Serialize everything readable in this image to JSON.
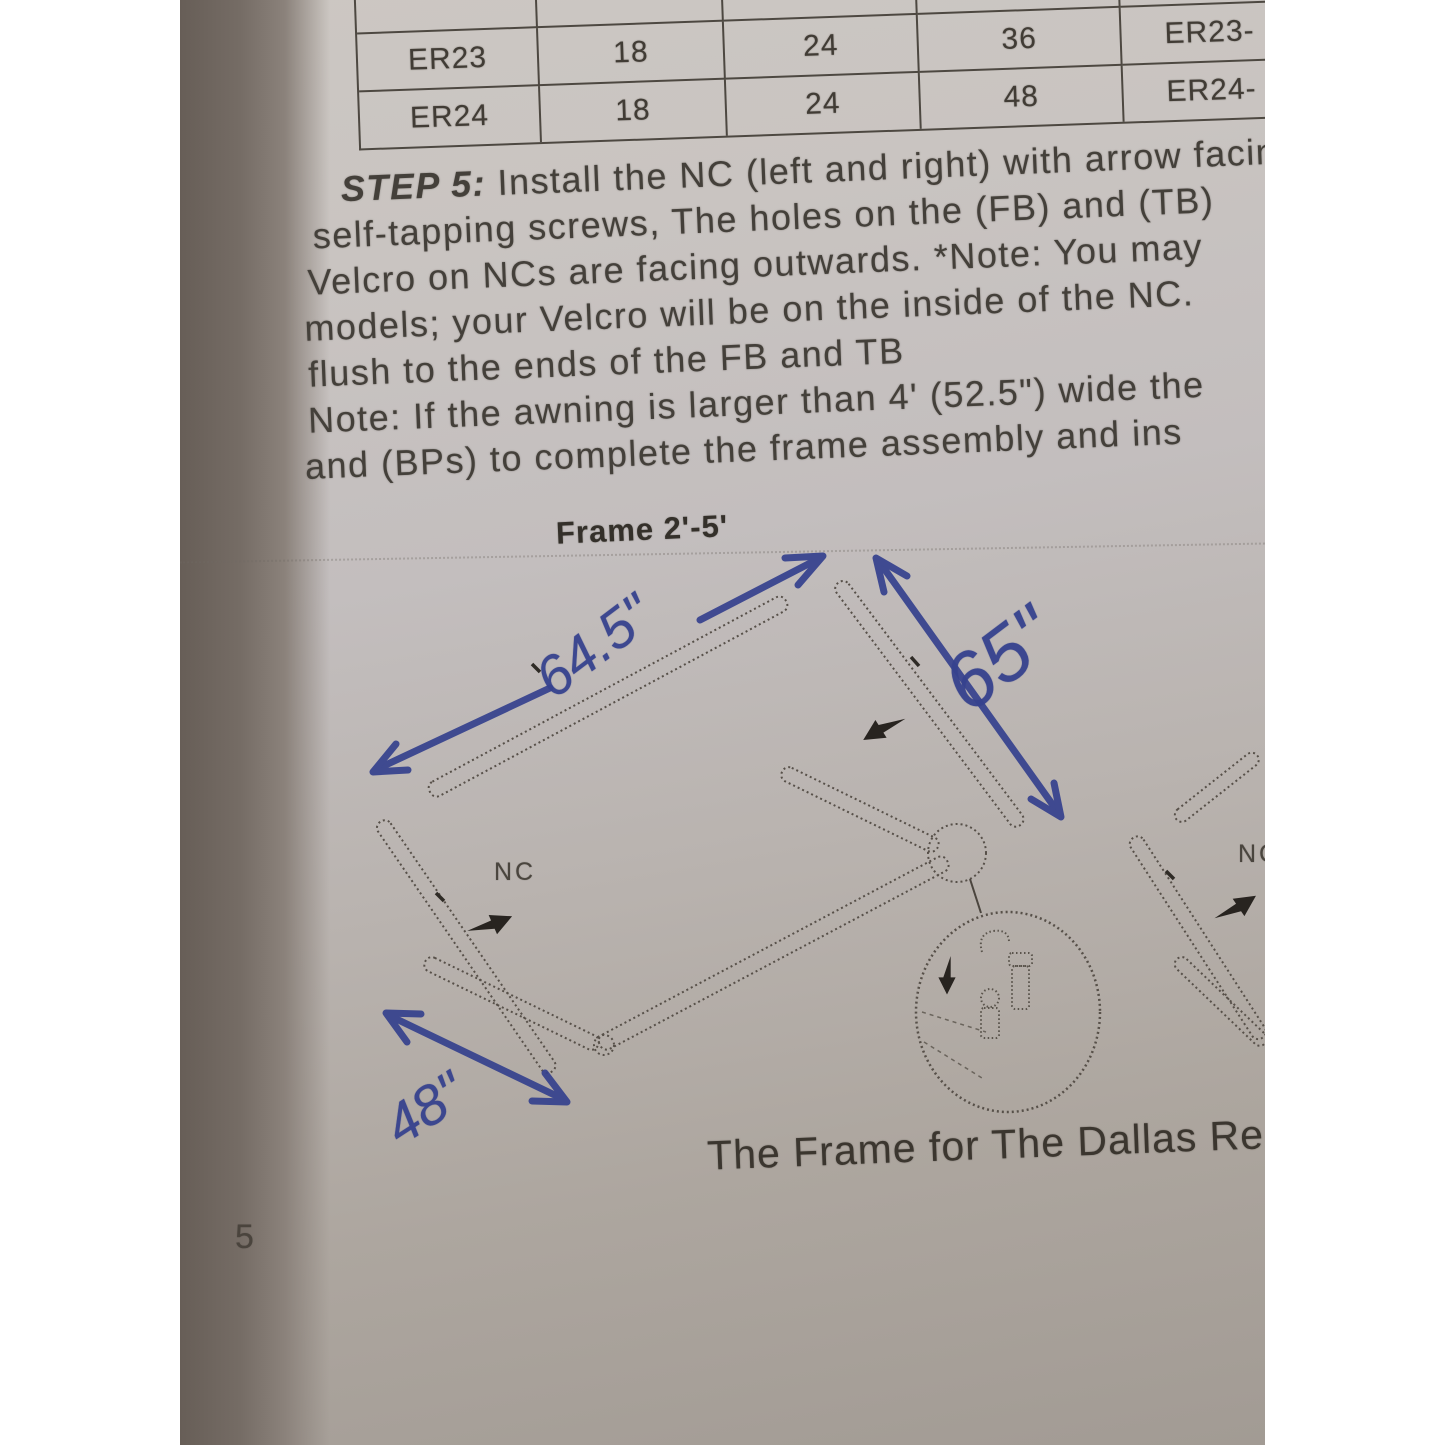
{
  "table": {
    "rows": [
      [
        "ER23",
        "18",
        "24",
        "36",
        "ER23-"
      ],
      [
        "ER24",
        "18",
        "24",
        "48",
        "ER24-"
      ]
    ]
  },
  "instructions": {
    "step_label": "STEP 5:",
    "step_rest": " Install the NC (left and right) with arrow facin",
    "lines": [
      "self-tapping screws, The holes on the (FB) and (TB)",
      "Velcro on NCs are facing outwards. *Note: You may",
      "models; your Velcro will be on the inside of the NC.",
      "flush to the ends of the FB and TB",
      "Note: If the awning is larger than 4' (52.5\") wide the",
      "and (BPs) to complete the frame assembly and ins"
    ]
  },
  "diagram": {
    "frame_label": "Frame 2'-5'",
    "dim_top": "64.5\"",
    "dim_right": "65\"",
    "dim_left": "48\"",
    "nc_left": "NC",
    "nc_right": "NC",
    "caption": "The Frame for The Dallas Re"
  },
  "page": {
    "number": "5"
  },
  "colors": {
    "pen_ink_blue": "#36428e",
    "print_gray": "#44403a",
    "paper_light": "#ccc7c2",
    "paper_dark": "#a29b94",
    "photo_edge_shadow": "#675e57"
  }
}
